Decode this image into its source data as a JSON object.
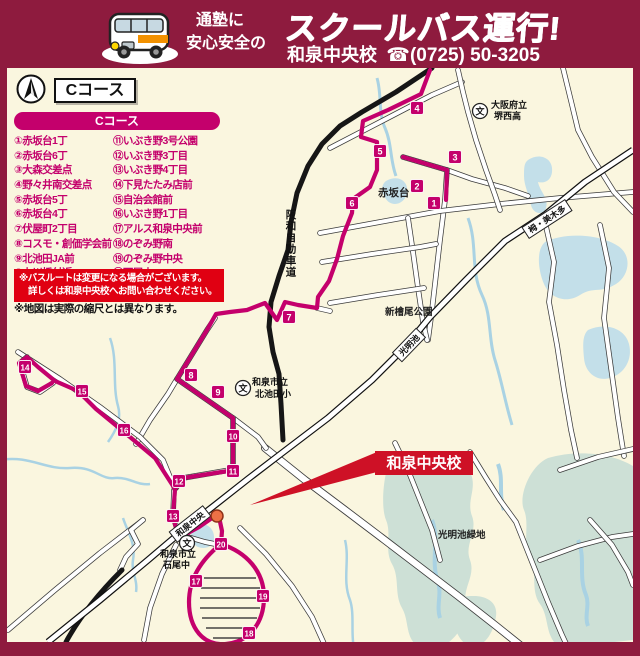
{
  "header": {
    "tagline_line1": "通塾に",
    "tagline_line2": "安心安全の",
    "title": "スクールバス運行!",
    "school_name": "和泉中央校",
    "phone_icon": "☎",
    "phone_number": "(0725) 50-3205"
  },
  "course": {
    "badge": "Cコース",
    "legend_title": "Cコース"
  },
  "stops": [
    {
      "no": "①",
      "num": "1",
      "name": "赤坂台1丁",
      "x": 434,
      "y": 203
    },
    {
      "no": "②",
      "num": "2",
      "name": "赤坂台6丁",
      "x": 417,
      "y": 186
    },
    {
      "no": "③",
      "num": "3",
      "name": "大森交差点",
      "x": 455,
      "y": 157
    },
    {
      "no": "④",
      "num": "4",
      "name": "野々井南交差点",
      "x": 417,
      "y": 108
    },
    {
      "no": "⑤",
      "num": "5",
      "name": "赤坂台5丁",
      "x": 380,
      "y": 151
    },
    {
      "no": "⑥",
      "num": "6",
      "name": "赤坂台4丁",
      "x": 352,
      "y": 203
    },
    {
      "no": "⑦",
      "num": "7",
      "name": "伏屋町2丁目",
      "x": 289,
      "y": 317
    },
    {
      "no": "⑧",
      "num": "8",
      "name": "コスモ・創価学会前",
      "x": 191,
      "y": 375
    },
    {
      "no": "⑨",
      "num": "9",
      "name": "北池田JA前",
      "x": 218,
      "y": 392
    },
    {
      "no": "⑩",
      "num": "10",
      "name": "上川橋付近",
      "x": 233,
      "y": 436
    },
    {
      "no": "⑪",
      "num": "11",
      "name": "いぶき野3号公園",
      "x": 233,
      "y": 471
    },
    {
      "no": "⑫",
      "num": "12",
      "name": "いぶき野3丁目",
      "x": 179,
      "y": 481
    },
    {
      "no": "⑬",
      "num": "13",
      "name": "いぶき野4丁目",
      "x": 173,
      "y": 516
    },
    {
      "no": "⑭",
      "num": "14",
      "name": "下見たたみ店前",
      "x": 25,
      "y": 367
    },
    {
      "no": "⑮",
      "num": "15",
      "name": "自治会館前",
      "x": 82,
      "y": 391
    },
    {
      "no": "⑯",
      "num": "16",
      "name": "いぶき野1丁目",
      "x": 124,
      "y": 430
    },
    {
      "no": "⑰",
      "num": "17",
      "name": "アルス和泉中央前",
      "x": 196,
      "y": 581
    },
    {
      "no": "⑱",
      "num": "18",
      "name": "のぞみ野南",
      "x": 249,
      "y": 633
    },
    {
      "no": "⑲",
      "num": "19",
      "name": "のぞみ野中央",
      "x": 263,
      "y": 596
    },
    {
      "no": "⑳",
      "num": "20",
      "name": "石尾山",
      "x": 221,
      "y": 544
    }
  ],
  "notes": {
    "notice_line1": "※バスルートは変更になる場合がございます。",
    "notice_line2": "詳しくは和泉中央校へお問い合わせください。",
    "scale_note": "※地図は実際の縮尺とは異なります。"
  },
  "map": {
    "destination_label": "和泉中央校",
    "schools": [
      {
        "icon": "文",
        "line1": "大阪府立",
        "line2": "堺西高",
        "cx": 480,
        "cy": 111,
        "tx": 491,
        "ty1": 108,
        "ty2": 119
      },
      {
        "icon": "文",
        "line1": "和泉市立",
        "line2": "北池田小",
        "cx": 243,
        "cy": 388,
        "tx": 252,
        "ty1": 385,
        "ty2": 397
      },
      {
        "icon": "文",
        "line1": "和泉市立",
        "line2": "石尾中",
        "cx": 187,
        "cy": 543,
        "tx": 160,
        "ty1": 557,
        "ty2": 568
      }
    ],
    "stations": [
      {
        "name": "栂・美木多",
        "x": 547,
        "y": 219,
        "angle": -33
      },
      {
        "name": "光明池",
        "x": 409,
        "y": 345,
        "angle": -46
      },
      {
        "name": "和泉中央",
        "x": 190,
        "y": 524,
        "angle": -38
      }
    ],
    "area_labels": [
      {
        "name": "赤坂台",
        "x": 378,
        "y": 196,
        "size": 10.5
      },
      {
        "name": "新檜尾公園",
        "x": 385,
        "y": 315,
        "size": 9.5
      },
      {
        "name": "光明池緑地",
        "x": 438,
        "y": 538,
        "size": 9.5
      }
    ],
    "expressway_label": "阪和自動車道"
  },
  "colors": {
    "maroon": "#8E1B3E",
    "cream": "#FAF6DF",
    "magenta": "#C4006C",
    "red": "#CE1126",
    "notice_red": "#E00012",
    "water": "#C3DFE9",
    "green_area": "#CDE0D6",
    "stream": "#A9D2E3"
  }
}
